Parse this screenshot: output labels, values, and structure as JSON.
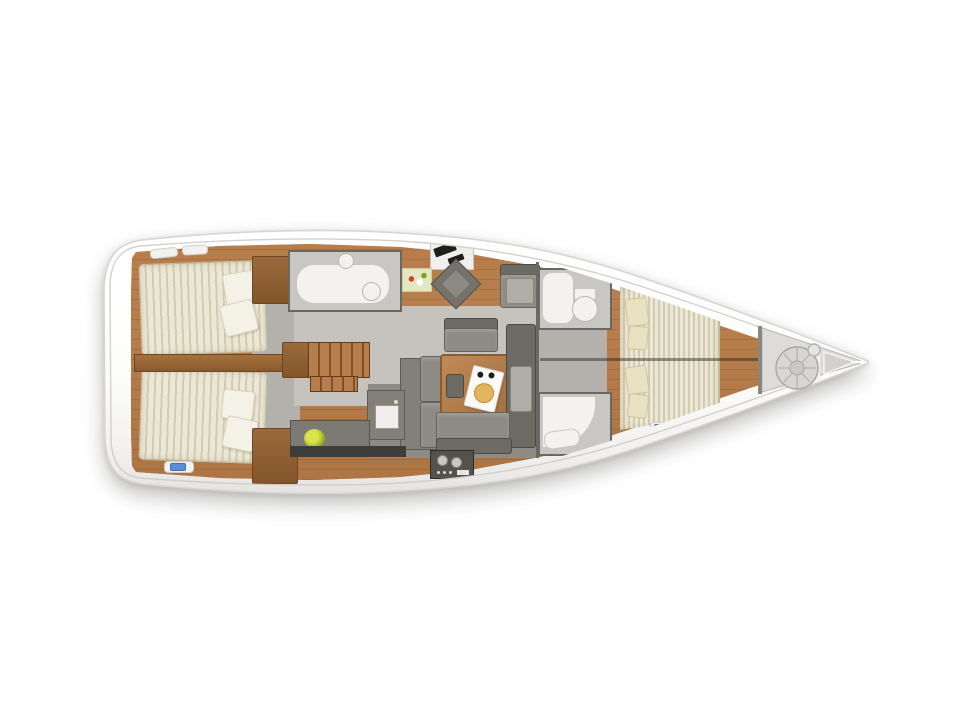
{
  "image": {
    "type": "yacht-interior-floorplan",
    "view": "top-down",
    "orientation": "bow-right"
  },
  "parts": [
    "hull",
    "side-decks",
    "aft-cabin-starboard",
    "aft-cabin-port",
    "cabin-divider",
    "companionway-stairs",
    "aft-head",
    "nav-station",
    "nav-chair",
    "salon-armchair",
    "salon-sofa-u",
    "salon-table",
    "serving-tray",
    "galley-counter",
    "galley-sink",
    "stove",
    "fruit-bowl",
    "fwd-head-upper",
    "fwd-head-lower",
    "owners-cabin-bed",
    "owners-cabin-pillows",
    "anchor-locker",
    "rope-coil"
  ],
  "colors": {
    "hull": "#ffffff",
    "hullStroke": "#d6d5d3",
    "wood": "#b77e4c",
    "woodDark2": "#a06838",
    "woodTrim": "#8a5a2e",
    "floor": "#c6c3be",
    "floorDark": "#8e8b84",
    "corridor": "#b4b1ac",
    "wall": "#6b6862",
    "bath": "#c9c7c3",
    "white": "#f3f2ef",
    "mattress": "#ece7d4",
    "mattressStripe": "#d2cbb1",
    "pillow": "#f4f1e6",
    "pillowFwd": "#e9e1c2",
    "sofa": "#8f8c85",
    "sofaDark": "#6e6b64",
    "cushion": "#b0ada6",
    "counter": "#7d7a74",
    "stove": "#55524c",
    "plantYellow": "#dce24a",
    "plantGreen": "#8fae22",
    "accentBlue": "#5b8ed6",
    "locker": "#dddcda",
    "bread": "#e2b65e"
  }
}
